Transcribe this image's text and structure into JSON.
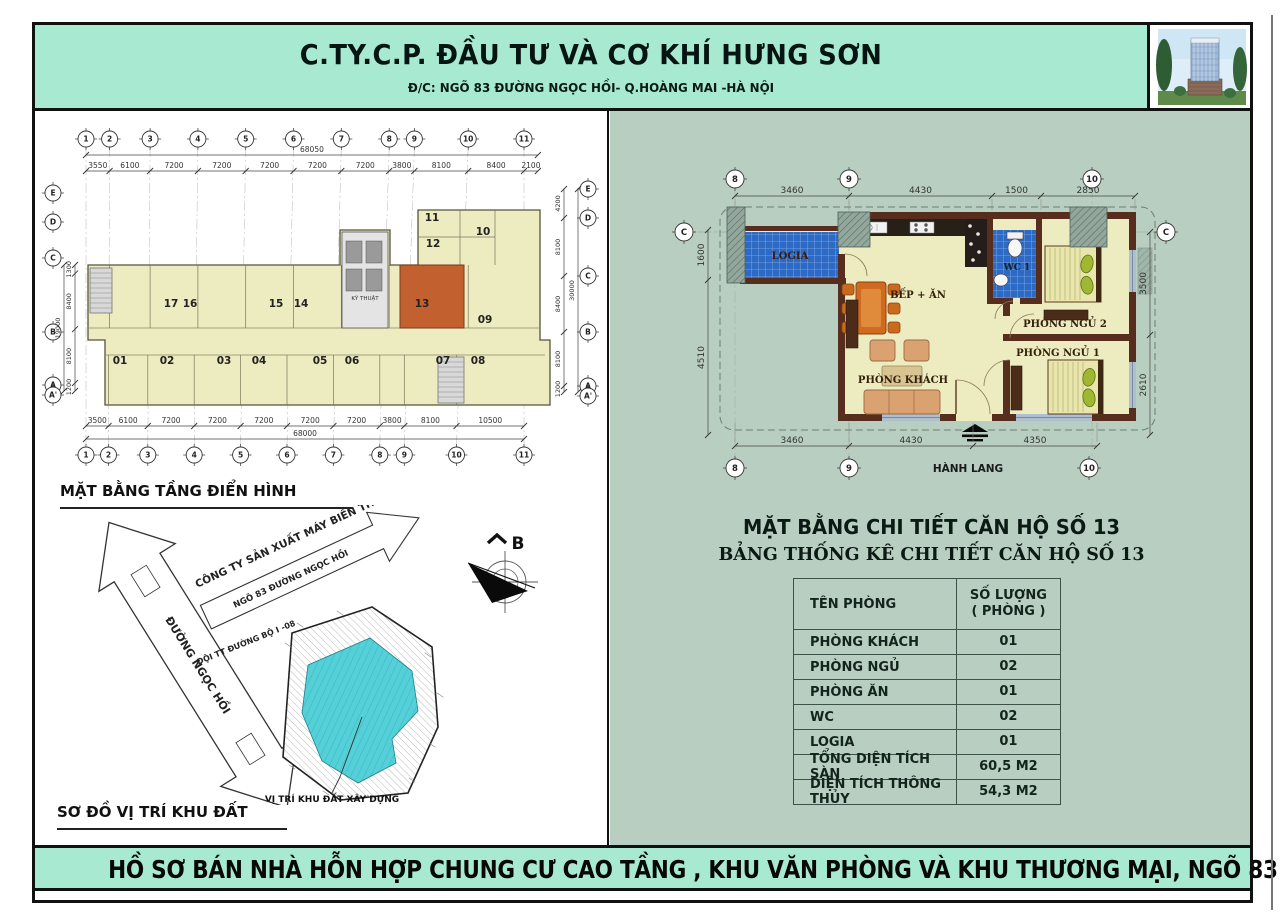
{
  "sheet": {
    "company": "C.TY.C.P. ĐẦU TƯ  VÀ CƠ KHÍ HƯNG SƠN",
    "address": "Đ/C: NGÕ 83 ĐƯỜNG NGỌC HỒI- Q.HOÀNG MAI -HÀ NỘI",
    "footer": "HỒ SƠ BÁN NHÀ HỖN HỢP CHUNG CƯ CAO TẦNG , KHU VĂN PHÒNG  VÀ KHU  THƯƠNG MẠI, NGÕ 83 NGỌC HỒI"
  },
  "typical_floor": {
    "caption": "MẶT BẰNG TẦNG ĐIỂN HÌNH",
    "grid_cols": [
      "1",
      "2",
      "3",
      "4",
      "5",
      "6",
      "7",
      "8",
      "9",
      "10",
      "11"
    ],
    "grid_rows": [
      "E",
      "D",
      "C",
      "B",
      "A",
      "A'"
    ],
    "dims_top_total": "68050",
    "dims_top": [
      "3550",
      "6100",
      "7200",
      "7200",
      "7200",
      "7200",
      "7200",
      "3800",
      "8100",
      "8400",
      "2100"
    ],
    "dims_bottom": [
      "3500",
      "6100",
      "7200",
      "7200",
      "7200",
      "7200",
      "7200",
      "3800",
      "8100",
      "10500"
    ],
    "dims_bottom_total": "68000",
    "dims_left": [
      "1300",
      "8400",
      "8100",
      "1200"
    ],
    "dims_left_total": "19000",
    "dims_right": [
      "4200",
      "8100",
      "8400",
      "8100",
      "1200"
    ],
    "dims_right_total": "30000",
    "units": [
      "01",
      "02",
      "03",
      "04",
      "05",
      "06",
      "07",
      "08",
      "09",
      "10",
      "11",
      "12",
      "13",
      "14",
      "15",
      "16",
      "17"
    ],
    "highlighted_unit": "13",
    "core_label": "KỸ THUẬT"
  },
  "site_plan": {
    "caption": "SƠ ĐỒ VỊ TRÍ KHU ĐẤT",
    "road_label": "ĐƯỜNG NGỌC HỒI",
    "alley_label": "NGÕ 83 ĐƯỜNG NGỌC HỒI",
    "company_label": "CÔNG TY SẢN XUẤT MÁY BIẾN THẾ ABB",
    "office_label": "ĐỘI TT ĐƯỜNG BỘ I -08",
    "site_label": "VỊ TRÍ KHU ĐẤT XÂY DỰNG",
    "north_label": "B"
  },
  "unit_plan": {
    "title": "MẶT BẰNG CHI TIẾT CĂN HỘ SỐ 13",
    "grid_cols": [
      "8",
      "9",
      "10"
    ],
    "grid_row": "C",
    "dims_top": [
      "3460",
      "4430",
      "1500",
      "2850"
    ],
    "dims_bottom": [
      "3460",
      "4430",
      "4350"
    ],
    "dims_left": [
      "1600",
      "4510"
    ],
    "dims_right": [
      "3500",
      "2610"
    ],
    "rooms": {
      "logia": "LOGIA",
      "kitchen": "BẾP + ĂN",
      "wc": "WC 1",
      "bedroom2": "PHÒNG NGỦ 2",
      "bedroom1": "PHÒNG NGỦ 1",
      "living": "PHÒNG KHÁCH",
      "corridor": "HÀNH LANG"
    }
  },
  "stats_table": {
    "title": "BẢNG THỐNG KÊ CHI TIẾT CĂN HỘ SỐ 13",
    "col1_header": "TÊN PHÒNG",
    "col2_header_1": "SỐ LƯỢNG",
    "col2_header_2": "( PHÒNG )",
    "rows": [
      {
        "name": "PHÒNG KHÁCH",
        "qty": "01"
      },
      {
        "name": "PHÒNG NGỦ",
        "qty": "02"
      },
      {
        "name": "PHÒNG ĂN",
        "qty": "01"
      },
      {
        "name": "WC",
        "qty": "02"
      },
      {
        "name": "LOGIA",
        "qty": "01"
      },
      {
        "name": "TỔNG DIỆN TÍCH SÀN",
        "qty": "60,5 M2"
      },
      {
        "name": "DIỆN TÍCH THÔNG THỦY",
        "qty": "54,3 M2"
      }
    ]
  },
  "colors": {
    "mint": "#a7e9d1",
    "sage": "#b8cec0",
    "floor_yellow": "#edebc0",
    "highlight_orange": "#c2602f",
    "tile_blue": "#2d6ac5",
    "wall_brown": "#572e1e",
    "site_cyan": "#55d0d8"
  }
}
